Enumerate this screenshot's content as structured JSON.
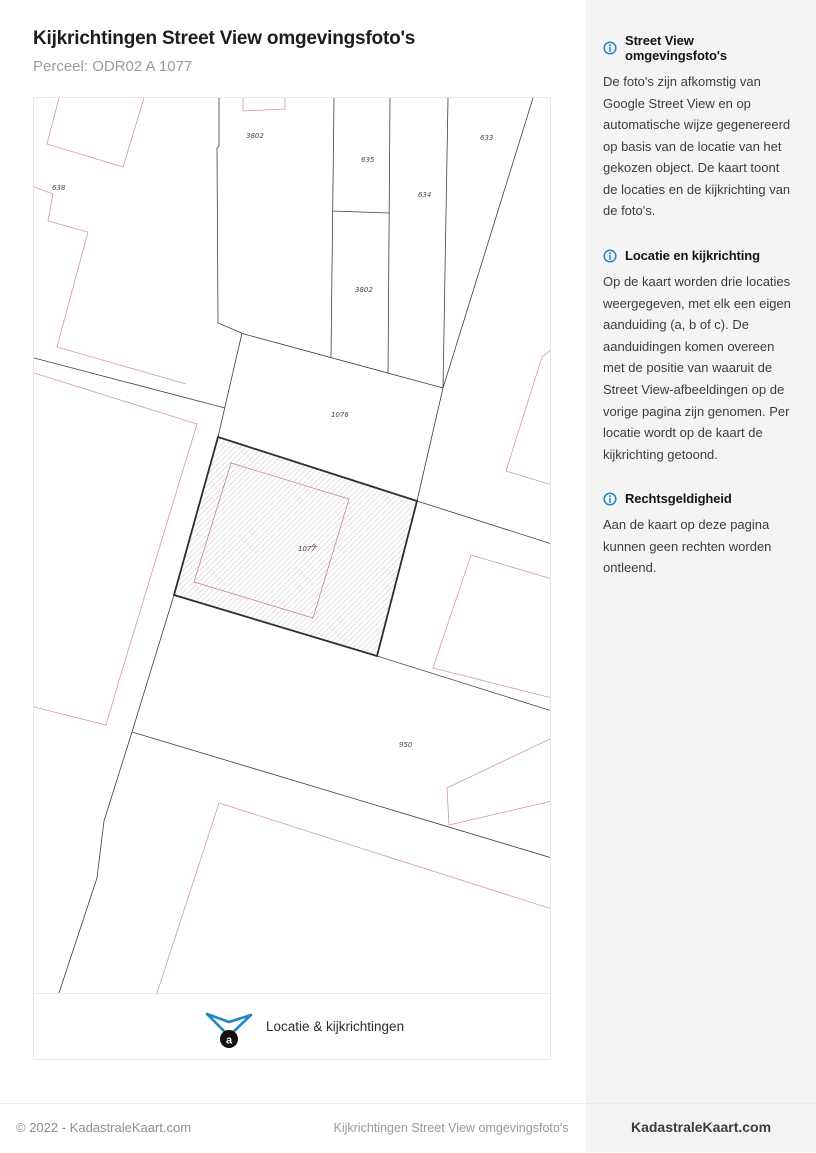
{
  "page": {
    "title": "Kijkrichtingen Street View omgevingsfoto's",
    "subtitle": "Perceel: ODR02 A 1077"
  },
  "map": {
    "parcels": [
      {
        "label": "638",
        "x": 18,
        "y": 92
      },
      {
        "label": "3802",
        "x": 212,
        "y": 40
      },
      {
        "label": "635",
        "x": 327,
        "y": 64
      },
      {
        "label": "633",
        "x": 446,
        "y": 42
      },
      {
        "label": "634",
        "x": 384,
        "y": 99
      },
      {
        "label": "3802",
        "x": 321,
        "y": 194
      },
      {
        "label": "1076",
        "x": 297,
        "y": 319
      },
      {
        "label": "1077",
        "x": 264,
        "y": 453
      },
      {
        "label": "950",
        "x": 365,
        "y": 649
      }
    ],
    "highlighted_parcel": "1077",
    "legend": {
      "label": "Locatie & kijkrichtingen",
      "marker_letter": "a"
    },
    "colors": {
      "boundary_black": "#3f3f3f",
      "building_red": "#d49a9a",
      "hatch_gray": "#c6c6c6",
      "legend_blue": "#1e88c5",
      "marker_black": "#111111"
    }
  },
  "sidebar": {
    "accent_color": "#1e88c5",
    "sections": [
      {
        "title": "Street View omgevingsfoto's",
        "body": "De foto's zijn afkomstig van Google Street View en op automatische wijze gegenereerd op basis van de locatie van het gekozen object. De kaart toont de locaties en de kijkrichting van de foto's."
      },
      {
        "title": "Locatie en kijkrichting",
        "body": "Op de kaart worden drie locaties weergegeven, met elk een eigen aanduiding (a, b of c). De aanduidingen komen overeen met de positie van waaruit de Street View-afbeeldingen op de vorige pagina zijn genomen. Per locatie wordt op de kaart de kijkrichting getoond."
      },
      {
        "title": "Rechtsgeldigheid",
        "body": "Aan de kaart op deze pagina kunnen geen rechten worden ontleend."
      }
    ]
  },
  "footer": {
    "copyright": "© 2022 - KadastraleKaart.com",
    "center": "Kijkrichtingen Street View omgevingsfoto's",
    "brand": "KadastraleKaart.com"
  }
}
